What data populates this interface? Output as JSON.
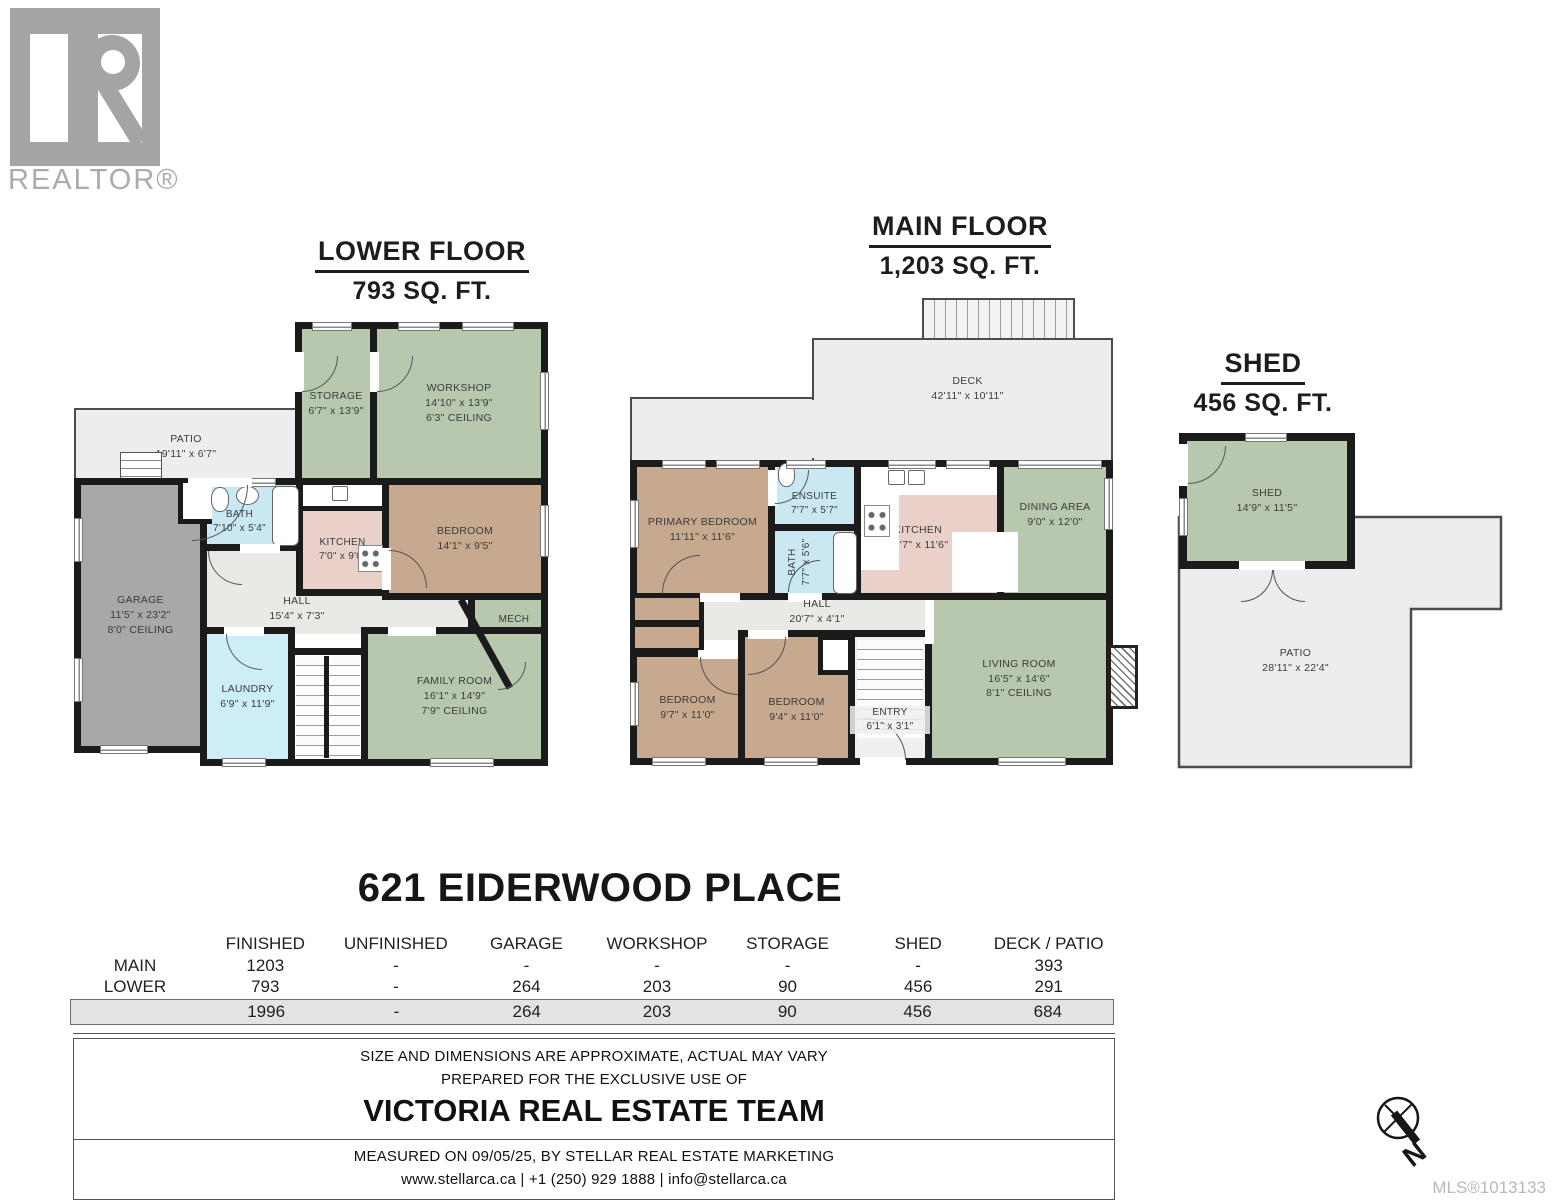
{
  "branding": {
    "logo_text": "REALTOR®",
    "mls_label": "MLS®1013133"
  },
  "titles": {
    "lower": {
      "name": "LOWER FLOOR",
      "area": "793 SQ. FT."
    },
    "main": {
      "name": "MAIN FLOOR",
      "area": "1,203 SQ. FT."
    },
    "shed": {
      "name": "SHED",
      "area": "456 SQ. FT."
    }
  },
  "lower_rooms": {
    "patio": {
      "name": "PATIO",
      "dims": "19'11\" x 6'7\""
    },
    "storage": {
      "name": "STORAGE",
      "dims": "6'7\" x 13'9\""
    },
    "workshop": {
      "name": "WORKSHOP",
      "dims": "14'10\" x 13'9\"",
      "ceiling": "6'3\" CEILING"
    },
    "garage": {
      "name": "GARAGE",
      "dims": "11'5\" x 23'2\"",
      "ceiling": "8'0\" CEILING"
    },
    "bath": {
      "name": "BATH",
      "dims": "7'10\" x 5'4\""
    },
    "kitchen": {
      "name": "KITCHEN",
      "dims": "7'0\" x 9'0\""
    },
    "bedroom": {
      "name": "BEDROOM",
      "dims": "14'1\" x 9'5\""
    },
    "hall": {
      "name": "HALL",
      "dims": "15'4\" x 7'3\""
    },
    "mech": {
      "name": "MECH ROOM",
      "dims": "6'6\" x 7'11\""
    },
    "laundry": {
      "name": "LAUNDRY",
      "dims": "6'9\" x 11'9\""
    },
    "family": {
      "name": "FAMILY ROOM",
      "dims": "16'1\" x 14'9\"",
      "ceiling": "7'9\" CEILING"
    }
  },
  "main_rooms": {
    "deck": {
      "name": "DECK",
      "dims": "42'11\" x 10'11\""
    },
    "primary": {
      "name": "PRIMARY BEDROOM",
      "dims": "11'11\" x 11'6\""
    },
    "ensuite": {
      "name": "ENSUITE",
      "dims": "7'7\" x 5'7\""
    },
    "bath": {
      "name": "BATH",
      "dims": "7'7\" x 5'6\""
    },
    "kitchen": {
      "name": "KITCHEN",
      "dims": "12'7\" x 11'6\""
    },
    "dining": {
      "name": "DINING AREA",
      "dims": "9'0\" x 12'0\""
    },
    "hall": {
      "name": "HALL",
      "dims": "20'7\" x 4'1\""
    },
    "bedroom1": {
      "name": "BEDROOM",
      "dims": "9'7\" x 11'0\""
    },
    "bedroom2": {
      "name": "BEDROOM",
      "dims": "9'4\" x 11'0\""
    },
    "entry": {
      "name": "ENTRY",
      "dims": "6'1\" x 3'1\""
    },
    "living": {
      "name": "LIVING ROOM",
      "dims": "16'5\" x 14'6\"",
      "ceiling": "8'1\" CEILING"
    }
  },
  "shed_rooms": {
    "shed": {
      "name": "SHED",
      "dims": "14'9\" x 11'5\""
    },
    "patio": {
      "name": "PATIO",
      "dims": "28'11\" x 22'4\""
    }
  },
  "address": "621 EIDERWOOD PLACE",
  "table": {
    "headers": [
      "FINISHED",
      "UNFINISHED",
      "GARAGE",
      "WORKSHOP",
      "STORAGE",
      "SHED",
      "DECK / PATIO"
    ],
    "rows": [
      {
        "label": "MAIN",
        "values": [
          "1203",
          "-",
          "-",
          "-",
          "-",
          "-",
          "393"
        ]
      },
      {
        "label": "LOWER",
        "values": [
          "793",
          "-",
          "264",
          "203",
          "90",
          "456",
          "291"
        ]
      }
    ],
    "total": [
      "1996",
      "-",
      "264",
      "203",
      "90",
      "456",
      "684"
    ]
  },
  "footer": {
    "line1": "SIZE AND DIMENSIONS ARE APPROXIMATE, ACTUAL MAY VARY",
    "line2": "PREPARED FOR THE EXCLUSIVE USE OF",
    "team": "VICTORIA REAL ESTATE TEAM",
    "line3": "MEASURED ON 09/05/25, BY STELLAR REAL ESTATE MARKETING",
    "line4": "www.stellarca.ca | +1 (250) 929 1888 | info@stellarca.ca"
  },
  "compass": {
    "label": "N"
  },
  "colors": {
    "wall": "#1b1b1b",
    "room_green": "#b7c8af",
    "room_tan": "#c7a98f",
    "room_pink": "#e9d1c9",
    "room_blue": "#c9e8f2",
    "room_blue_light": "#cdeef7",
    "garage_gray": "#a8a8a8",
    "hall_gray": "#e9eae6",
    "outdoor_gray": "#ededed"
  }
}
